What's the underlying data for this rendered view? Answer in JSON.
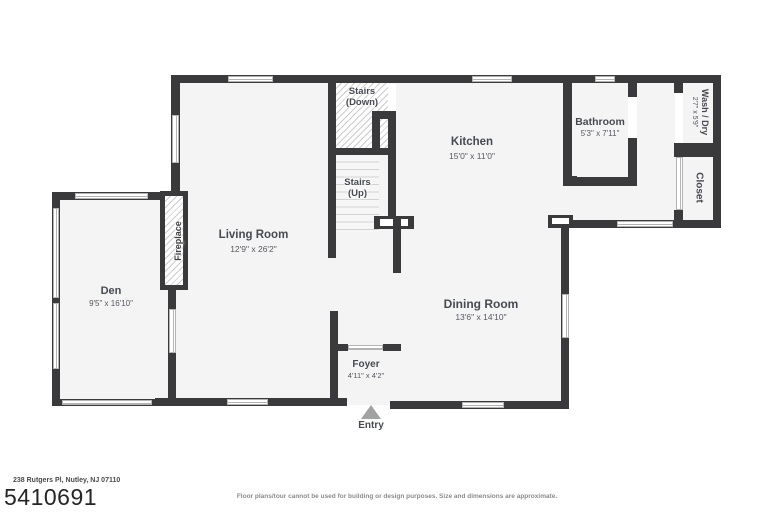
{
  "rooms": {
    "living": {
      "name": "Living Room",
      "dims": "12'9\" x 26'2\""
    },
    "den": {
      "name": "Den",
      "dims": "9'5\" x 16'10\""
    },
    "kitchen": {
      "name": "Kitchen",
      "dims": "15'0\" x 11'0\""
    },
    "dining": {
      "name": "Dining Room",
      "dims": "13'6\" x 14'10\""
    },
    "bathroom": {
      "name": "Bathroom",
      "dims": "5'3\" x 7'11\""
    },
    "foyer": {
      "name": "Foyer",
      "dims": "4'11\" x 4'2\""
    },
    "washdry": {
      "name": "Wash / Dry",
      "dims": "2'7\" x 5'9\""
    },
    "closet": {
      "name": "Closet"
    },
    "stairs_down": {
      "line1": "Stairs",
      "line2": "(Down)"
    },
    "stairs_up": {
      "line1": "Stairs",
      "line2": "(Up)"
    },
    "fireplace": {
      "name": "Fireplace"
    },
    "entry": {
      "name": "Entry"
    }
  },
  "footer": {
    "address": "238 Rutgers Pl, Nutley, NJ 07110",
    "listing_number": "5410691",
    "disclaimer": "Floor plans/tour cannot be used for building or design purposes. Size and dimensions are approximate."
  },
  "colors": {
    "wall": "#3a3a3c",
    "floor": "#f4f4f4",
    "label": "#474a52",
    "entry_arrow": "#a2a2a2"
  }
}
